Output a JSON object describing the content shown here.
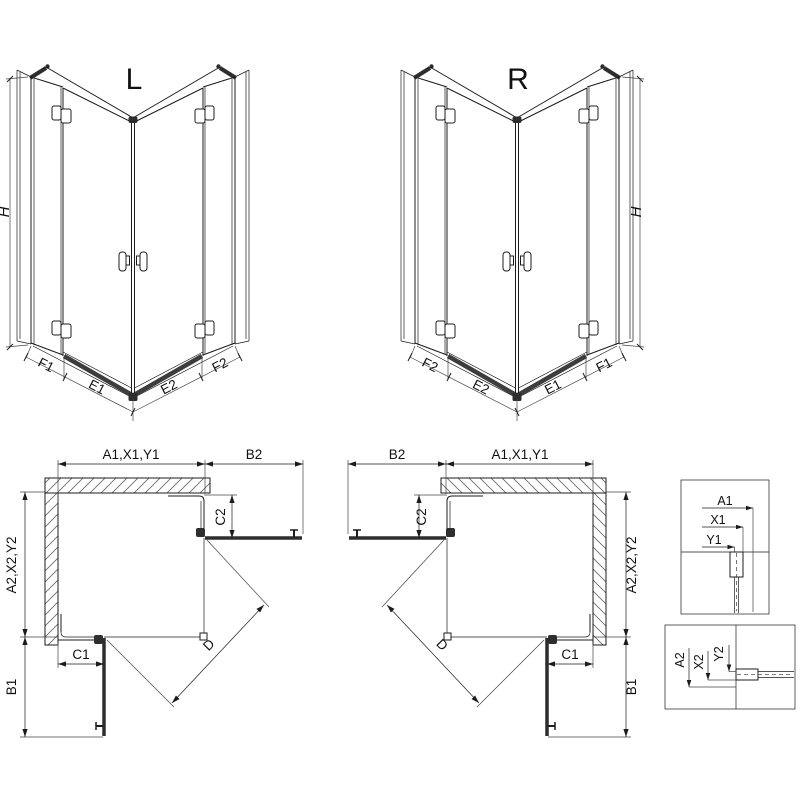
{
  "drawing": {
    "iso_left": {
      "title": "L",
      "height_label": "H",
      "segments": [
        "F1",
        "E1",
        "E2",
        "F2"
      ]
    },
    "iso_right": {
      "title": "R",
      "height_label": "H",
      "segments": [
        "F2",
        "E2",
        "E1",
        "F1"
      ]
    },
    "plan_left": {
      "width_top": "A1,X1,Y1",
      "door_side": "B2",
      "fixed_side": "C2",
      "depth": "A2,X2,Y2",
      "door_bottom": "B1",
      "fixed_bottom": "C1",
      "diagonal": "D"
    },
    "plan_right": {
      "width_top": "A1,X1,Y1",
      "door_side": "B2",
      "fixed_side": "C2",
      "depth": "A2,X2,Y2",
      "door_bottom": "B1",
      "fixed_bottom": "C1",
      "diagonal": "D"
    },
    "detail_width": {
      "dims": [
        "A1",
        "X1",
        "Y1"
      ]
    },
    "detail_depth": {
      "dims": [
        "A2",
        "X2",
        "Y2"
      ]
    }
  },
  "colors": {
    "line": "#1c1c1c",
    "threshold": "#3d3d3d",
    "door": "#2e2e2e",
    "hatch": "#666666",
    "background": "#ffffff"
  }
}
